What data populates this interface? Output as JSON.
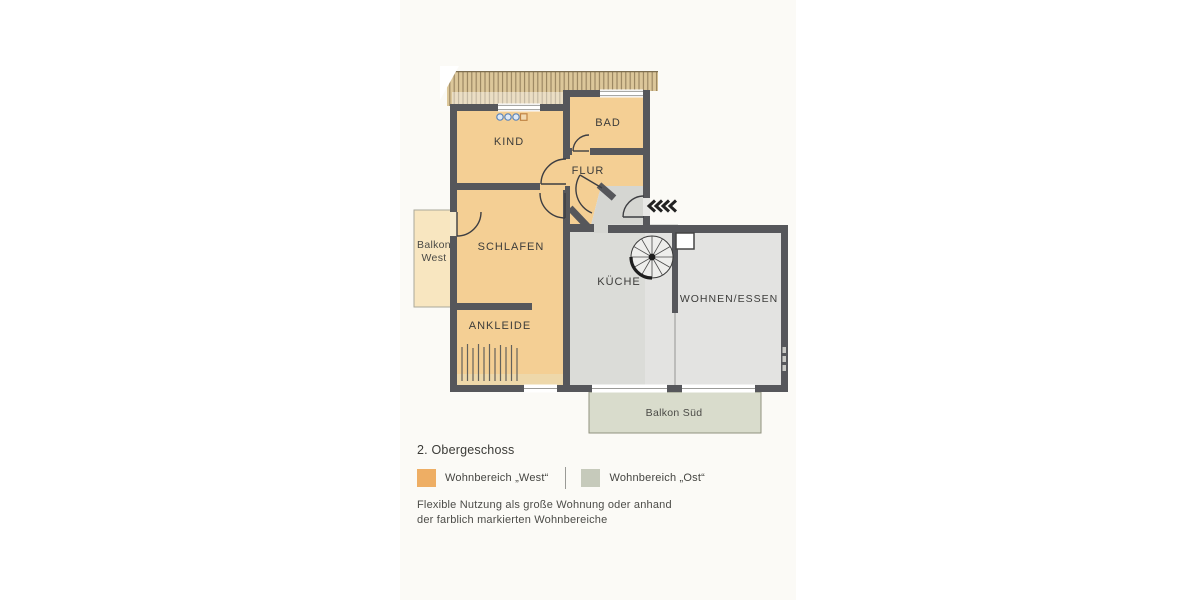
{
  "plan": {
    "floor_title": "2. Obergeschoss",
    "rooms": {
      "kind": "KIND",
      "bad": "BAD",
      "flur": "FLUR",
      "schlafen": "SCHLAFEN",
      "ankleide": "ANKLEIDE",
      "kueche": "KÜCHE",
      "wohnen_essen": "WOHNEN/ESSEN",
      "balkon_west_line1": "Balkon",
      "balkon_west_line2": "West",
      "balkon_sued": "Balkon Süd"
    },
    "colors": {
      "wall": "#56575b",
      "west_room_fill": "#f4cf94",
      "ost_kueche_fill": "#dbdcd8",
      "ost_wohnen_fill": "#e3e3e1",
      "ost_landing_fill": "#d5d6d2",
      "balkon_west_fill": "#f8e6c0",
      "balkon_sued_fill": "#d9dccc",
      "roof_hatch_fill": "#dcc79a"
    },
    "symbols": {
      "entry_direction": "four-left-chevrons",
      "stair": "spiral-staircase",
      "kind_logo": "three-blue-dots-and-orange-square"
    }
  },
  "legend": {
    "heading": "2. Obergeschoss",
    "items": [
      {
        "label": "Wohnbereich „West“",
        "color": "#eeae64"
      },
      {
        "label": "Wohnbereich „Ost“",
        "color": "#c6cabb"
      }
    ]
  },
  "notes": {
    "line1": "Flexible Nutzung als große Wohnung oder anhand",
    "line2": "der farblich markierten Wohnbereiche"
  }
}
